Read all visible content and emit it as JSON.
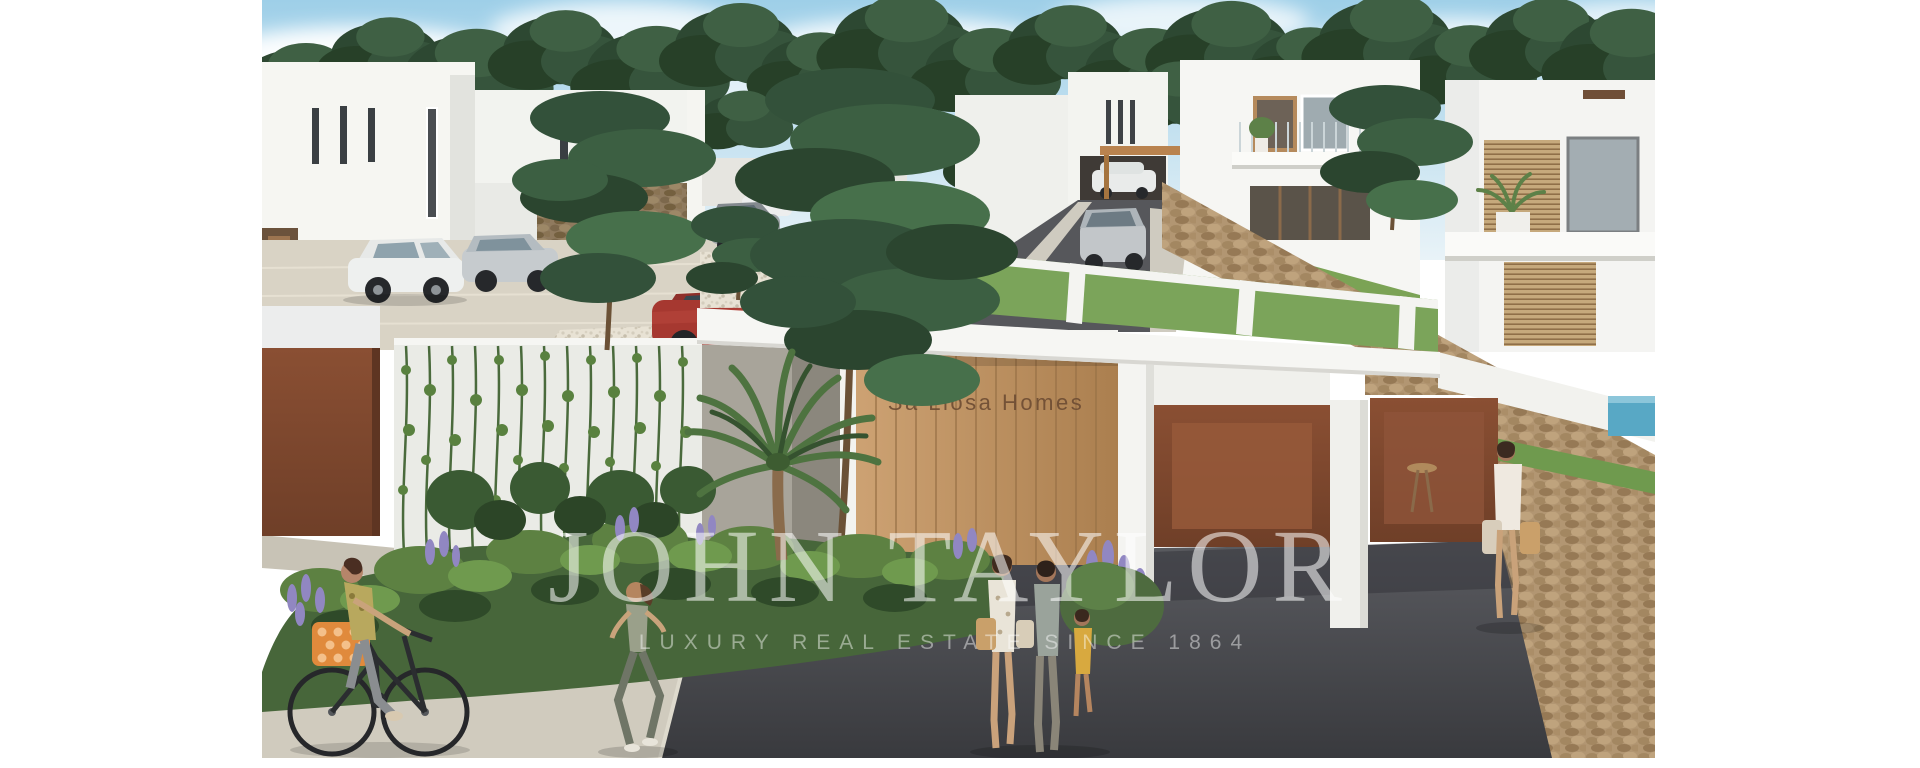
{
  "photo": {
    "alt": "3D architectural rendering of a modern white villa development among pine trees, with an entrance gate, wooden door, corten garage doors, stone walls, parked cars, a cyclist, a jogger, a walking family and a standing woman",
    "kind": "real-estate rendering"
  },
  "watermark": {
    "title": "JOHN TAYLOR",
    "subtitle": "LUXURY REAL ESTATE SINCE 1864",
    "color": "#ffffff",
    "title_opacity": "0.55",
    "subtitle_opacity": "0.45"
  },
  "signage": {
    "gate_text": "Sa Llosa Homes",
    "color": "#6d4c33"
  },
  "palette": {
    "sky_top": "#9ecfe8",
    "sky_bottom": "#e9f3f8",
    "pine_dark": "#2d4832",
    "pine_light": "#47704b",
    "building_white": "#f5f5f2",
    "stone": "#b29672",
    "wood_light": "#cda273",
    "wood_dark": "#ab7f4f",
    "corten_light": "#8a4f33",
    "corten_dark": "#6f3f28",
    "asphalt_light": "#5a5b60",
    "asphalt_dark": "#393a3e",
    "sidewalk": "#d0cbbe",
    "hedge_green": "#47663a",
    "lavender": "#9187c2",
    "pool_blue": "#58a8c5"
  }
}
